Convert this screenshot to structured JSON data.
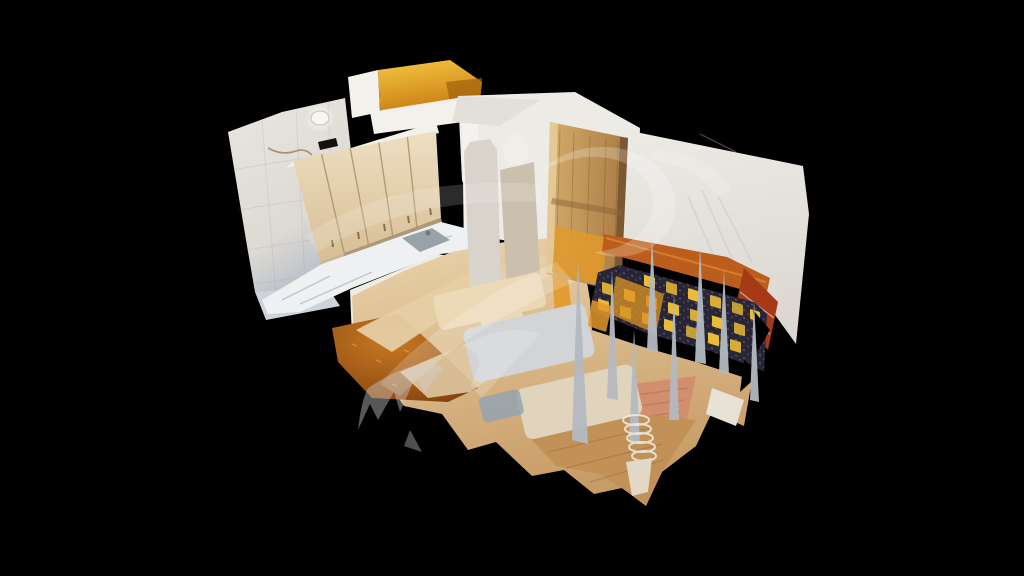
{
  "viewer": {
    "type": "3d-dollhouse-scan-viewer",
    "scene": "kitchen-and-seating-room-cutaway",
    "watermark": "swoosh-watermark"
  },
  "colors": {
    "background": "#000000",
    "wall_left_top": "#e9e6e0",
    "wall_left_bottom": "#b7bfca",
    "bevel": "#ccd3da",
    "ceiling_light": "#f7f6f1",
    "vent_black": "#141210",
    "cornice_white": "#f3f1ec",
    "cabinet_cream_light": "#eedfc2",
    "cabinet_cream_dark": "#d7bd94",
    "cabinet_seam": "#a9906a",
    "counter_white": "#eef0f1",
    "sink_steel": "#98a2a9",
    "lower_cabinet_white": "#efece4",
    "gold_door_light": "#f7c844",
    "gold_door_dark": "#c87d12",
    "wall_white": "#edebe6",
    "wall_dim": "#dcd8d1",
    "slab_gray": "#d8d3cb",
    "slab_taupe": "#cbbfae",
    "ramp_beige": "#e5cda4",
    "wood_fridge_light": "#d6ae6e",
    "wood_fridge_dark": "#aa7c44",
    "amber_panel": "#e2992b",
    "rust_band": "#bb5e1d",
    "red_tile": "#a63a17",
    "sofa_navy": "#282636",
    "sofa_gold": "#e9bb36",
    "floor_beige_light": "#ead4ac",
    "floor_beige_dark": "#c89c66",
    "carpet_orange_light": "#c97a22",
    "carpet_orange_dark": "#7c3c0d",
    "rug_salmon": "#d18f6f",
    "floor_wood": "#c29157",
    "patch_beige": "#ecd9b6",
    "patch_gray": "#d2d4d5",
    "patch_tan": "#e0d4bd",
    "patch_blue": "#90a2b4",
    "artifact_gray": "#b4bac2",
    "watermark_white": "#ffffff",
    "watermark_gray": "#cfcfcf"
  }
}
